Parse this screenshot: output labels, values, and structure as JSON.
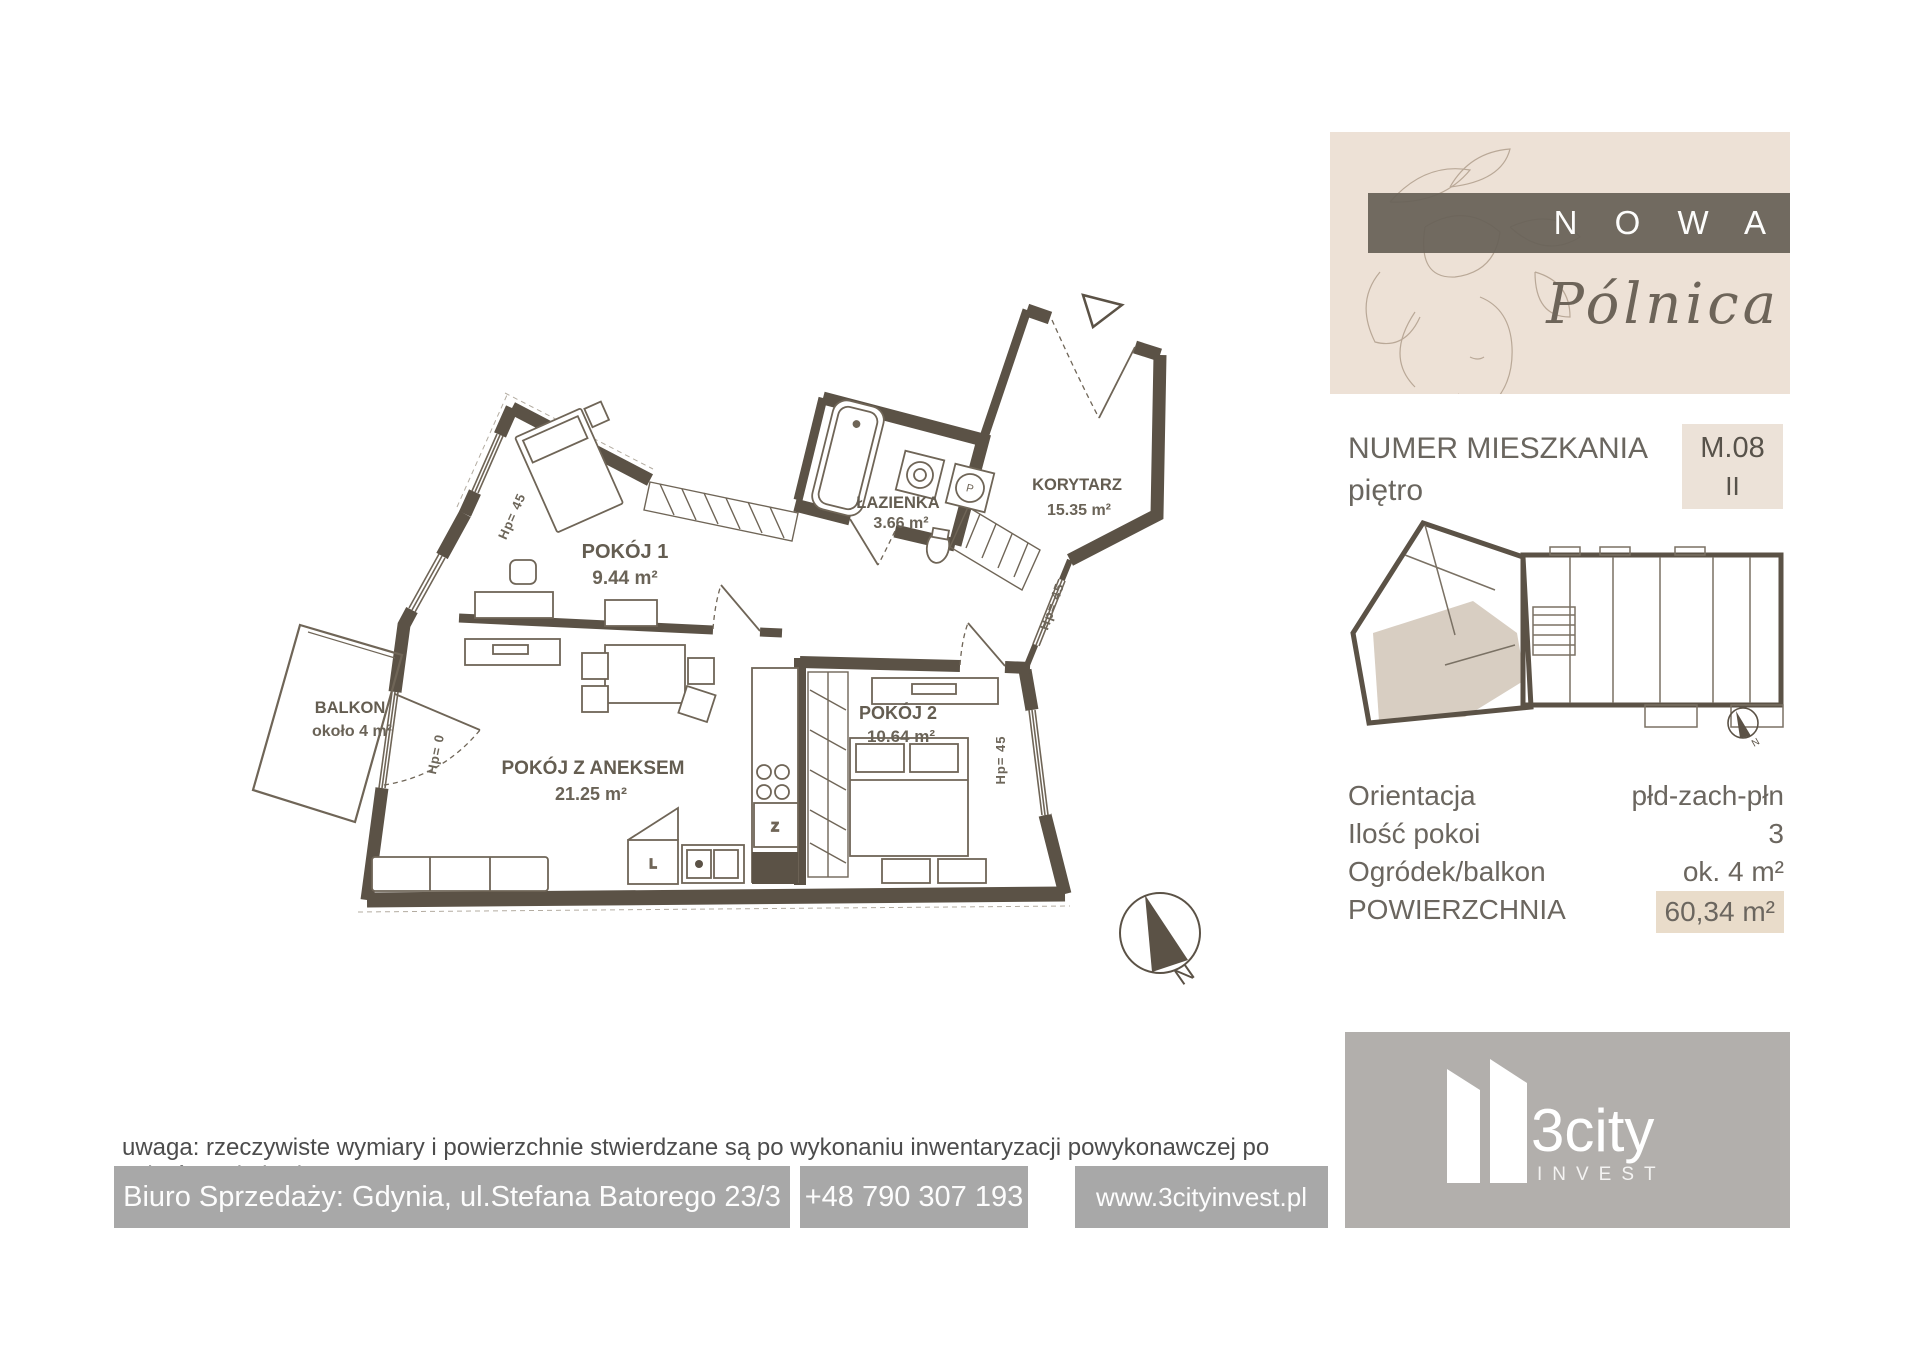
{
  "brand": {
    "title": "N O W A",
    "subtitle": "Pólnica"
  },
  "unit": {
    "number_label": "NUMER MIESZKANIA",
    "floor_label": "piętro",
    "number_value": "M.08",
    "floor_value": "II"
  },
  "details": [
    {
      "label": "Orientacja",
      "value": "płd-zach-płn"
    },
    {
      "label": "Ilość pokoi",
      "value": "3"
    },
    {
      "label": "Ogródek/balkon",
      "value": "ok. 4 m²"
    },
    {
      "label": "POWIERZCHNIA",
      "value": "60,34 m²"
    }
  ],
  "rooms": [
    {
      "name": "POKÓJ 1",
      "area": "9.44 m²"
    },
    {
      "name": "ŁAZIENKA",
      "area": "3.66 m²"
    },
    {
      "name": "KORYTARZ",
      "area": "15.35 m²"
    },
    {
      "name": "POKÓJ 2",
      "area": "10.64 m²"
    },
    {
      "name": "POKÓJ Z ANEKSEM",
      "area": "21.25 m²"
    },
    {
      "name": "BALKON",
      "area": "około 4 m²"
    }
  ],
  "annotations": {
    "hp45": "Hp= 45",
    "hp0": "Hp= 0",
    "north": "N",
    "washer_label": "P",
    "sink_label": "Z",
    "fridge_label": "L"
  },
  "footer": {
    "note": "uwaga: rzeczywiste wymiary i powierzchnie stwierdzane są po wykonaniu inwentaryzacji powykonawczej po zakończeniu budowy",
    "office": "Biuro Sprzedaży: Gdynia, ul.Stefana Batorego 23/3",
    "phone": "+48 790 307 193",
    "website": "www.3cityinvest.pl"
  },
  "company": {
    "name": "3city",
    "sub": "INVEST"
  },
  "colors": {
    "wall": "#5b5246",
    "beige_panel": "#ede1d6",
    "value_box": "#ece2d8",
    "highlight_box": "#e9dcca",
    "banner": "#676157",
    "footer_gray": "#a8a8a8",
    "logo_gray": "#b2afac",
    "minimap_highlight": "#d8cec2"
  }
}
